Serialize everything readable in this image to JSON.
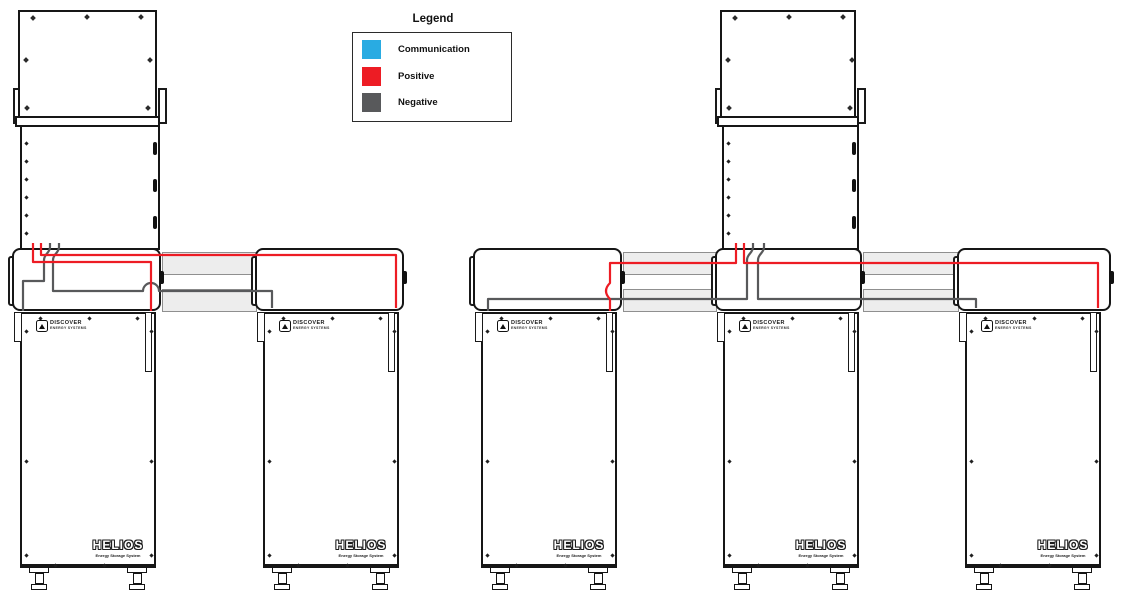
{
  "legend": {
    "title": "Legend",
    "items": [
      {
        "label": "Communication",
        "color": "#29abe2"
      },
      {
        "label": "Positive",
        "color": "#ed1c24"
      },
      {
        "label": "Negative",
        "color": "#58595b"
      }
    ]
  },
  "labels": {
    "inverter": "INVERTER"
  },
  "branding": {
    "discover_name": "DISCOVER",
    "discover_tagline": "ENERGY SYSTEMS",
    "helios_name": "HELIOS",
    "helios_tagline": "Energy Storage System"
  },
  "colors": {
    "communication": "#29abe2",
    "positive": "#ed1c24",
    "negative": "#58595b",
    "tray_fill": "#ededed",
    "outline": "#161616"
  },
  "system_overview": {
    "left_bank": {
      "inverters": 1,
      "batteries": 2
    },
    "right_bank": {
      "inverters": 1,
      "batteries": 3
    }
  }
}
